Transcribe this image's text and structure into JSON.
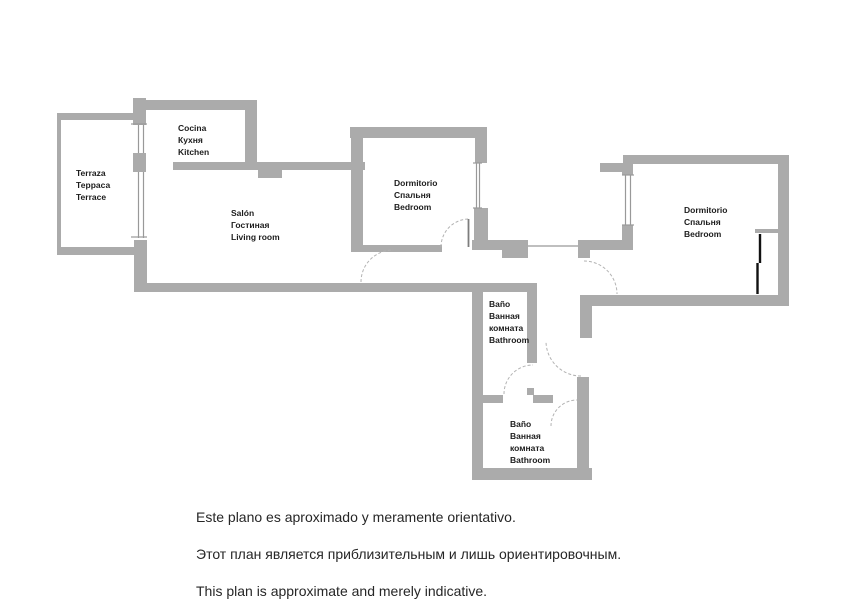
{
  "title": "Apartment floor plan",
  "colors": {
    "wall": "#ababab",
    "window_line": "#999999",
    "tick": "#9a9a9a",
    "arc": "#b3b3b3",
    "leaf": "#7d7d7d",
    "wardrobe": "#111111",
    "label": "#1c1c1c",
    "note_text": "#262626",
    "background": "#ffffff"
  },
  "rooms": [
    {
      "id": "terrace",
      "x": 76,
      "baselines": [
        176,
        188,
        200
      ],
      "lines": [
        "Terraza",
        "Терраса",
        "Terrace"
      ]
    },
    {
      "id": "kitchen",
      "x": 178,
      "baselines": [
        131,
        143,
        155
      ],
      "lines": [
        "Cocina",
        "Кухня",
        "Kitchen"
      ]
    },
    {
      "id": "living-room",
      "x": 231,
      "baselines": [
        216,
        228,
        240
      ],
      "lines": [
        "Salón",
        "Гостиная",
        "Living room"
      ]
    },
    {
      "id": "bedroom-1",
      "x": 394,
      "baselines": [
        186,
        198,
        210
      ],
      "lines": [
        "Dormitorio",
        "Спальня",
        "Bedroom"
      ]
    },
    {
      "id": "bedroom-2",
      "x": 684,
      "baselines": [
        213,
        225,
        237
      ],
      "lines": [
        "Dormitorio",
        "Спальня",
        "Bedroom"
      ]
    },
    {
      "id": "bathroom-1",
      "x": 489,
      "baselines": [
        307,
        319,
        331,
        343
      ],
      "lines": [
        "Baño",
        "Ванная",
        "комната",
        "Bathroom"
      ]
    },
    {
      "id": "bathroom-2",
      "x": 510,
      "baselines": [
        427,
        439,
        451,
        463
      ],
      "lines": [
        "Baño",
        "Ванная",
        "комната",
        "Bathroom"
      ]
    }
  ],
  "walls": [
    [
      57,
      113,
      76,
      7
    ],
    [
      57,
      113,
      4,
      142
    ],
    [
      57,
      247,
      78,
      8
    ],
    [
      133,
      98,
      13,
      27
    ],
    [
      133,
      153,
      13,
      19
    ],
    [
      134,
      240,
      13,
      52
    ],
    [
      133,
      100,
      124,
      10
    ],
    [
      245,
      110,
      12,
      52
    ],
    [
      173,
      162,
      192,
      8
    ],
    [
      258,
      170,
      24,
      8
    ],
    [
      350,
      127,
      137,
      11
    ],
    [
      351,
      138,
      12,
      112
    ],
    [
      475,
      138,
      12,
      25
    ],
    [
      474,
      208,
      14,
      42
    ],
    [
      472,
      240,
      56,
      10
    ],
    [
      502,
      250,
      26,
      8
    ],
    [
      351,
      245,
      91,
      7
    ],
    [
      578,
      240,
      55,
      10
    ],
    [
      578,
      250,
      12,
      8
    ],
    [
      580,
      295,
      12,
      43
    ],
    [
      577,
      377,
      12,
      93
    ],
    [
      580,
      295,
      207,
      11
    ],
    [
      623,
      155,
      164,
      9
    ],
    [
      600,
      163,
      23,
      9
    ],
    [
      622,
      164,
      11,
      11
    ],
    [
      622,
      225,
      11,
      25
    ],
    [
      778,
      155,
      11,
      151
    ],
    [
      755,
      229,
      23,
      4
    ],
    [
      135,
      283,
      402,
      9
    ],
    [
      472,
      292,
      11,
      178
    ],
    [
      527,
      292,
      10,
      71
    ],
    [
      527,
      388,
      7,
      7
    ],
    [
      483,
      395,
      20,
      8
    ],
    [
      533,
      395,
      20,
      8
    ],
    [
      472,
      468,
      120,
      12
    ]
  ],
  "thin_lines": [
    [
      138.5,
      125,
      138.5,
      153
    ],
    [
      143.5,
      125,
      143.5,
      153
    ],
    [
      138.5,
      172,
      138.5,
      238
    ],
    [
      143.5,
      172,
      143.5,
      238
    ],
    [
      476.5,
      163,
      476.5,
      208
    ],
    [
      479.5,
      163,
      479.5,
      208
    ],
    [
      625.5,
      175,
      625.5,
      225
    ],
    [
      630.5,
      175,
      630.5,
      225
    ],
    [
      528,
      246,
      578,
      246
    ]
  ],
  "ticks": [
    [
      131,
      124,
      147,
      124
    ],
    [
      131,
      237,
      147,
      237
    ],
    [
      473,
      163,
      482,
      163
    ],
    [
      473,
      208,
      482,
      208
    ],
    [
      622,
      175,
      634,
      175
    ],
    [
      622,
      225,
      634,
      225
    ]
  ],
  "door_arcs": [
    {
      "d": "M441,247 A28,28 0 0 1 469,219"
    },
    {
      "d": "M361,282 A32,32 0 0 1 393,250"
    },
    {
      "d": "M584,261 A33,33 0 0 1 617,294"
    },
    {
      "d": "M581,376 A35,35 0 0 1 546,341"
    },
    {
      "d": "M551,426 A26,26 0 0 1 577,400"
    },
    {
      "d": "M504,394 A29,29 0 0 1 533,365"
    }
  ],
  "door_leaves": [
    [
      468.5,
      219,
      468.5,
      247
    ]
  ],
  "wardrobe_lines": [
    [
      760,
      234,
      760,
      263
    ],
    [
      757.5,
      263,
      757.5,
      294
    ]
  ],
  "notes": {
    "es": "Este plano es aproximado y meramente orientativo.",
    "ru": "Этот план является приблизительным и лишь ориентировочным.",
    "en": "This plan is approximate and merely indicative."
  }
}
